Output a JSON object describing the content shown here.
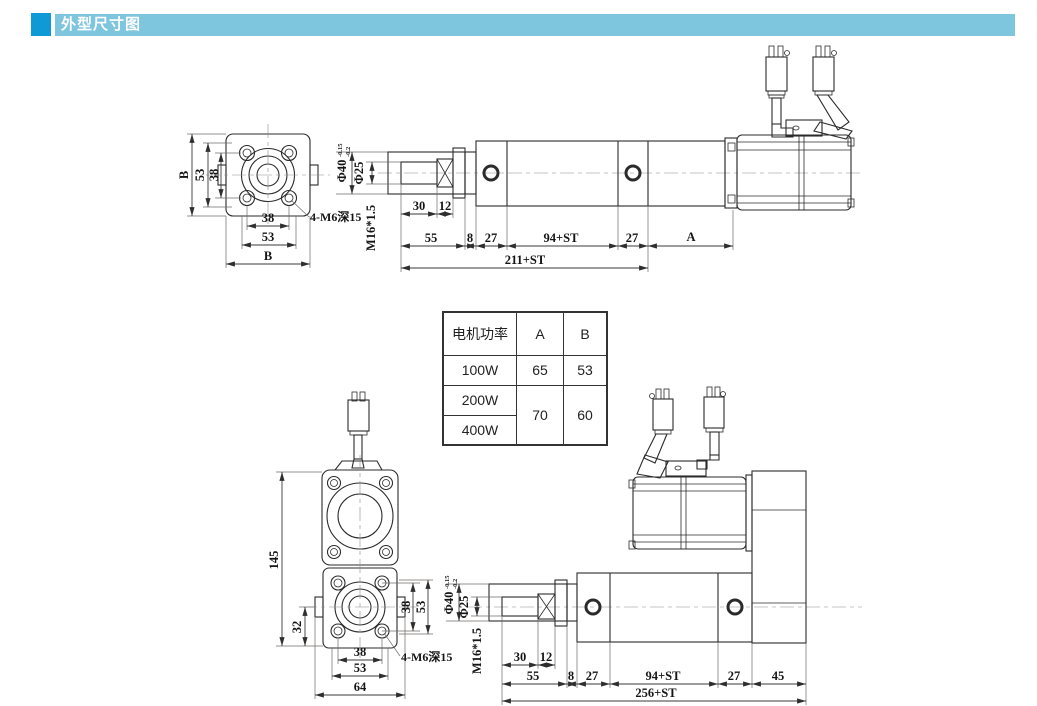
{
  "header": {
    "title": "外型尺寸图"
  },
  "colors": {
    "accent": "#0f9ad6",
    "banner": "#7ec5de",
    "line": "#2b2b2b"
  },
  "table": {
    "col_headers": [
      "电机功率",
      "A",
      "B"
    ],
    "rows": [
      {
        "power": "100W",
        "a": "65",
        "b": "53"
      },
      {
        "power": "200W"
      },
      {
        "power": "400W"
      }
    ],
    "merged": {
      "a": "70",
      "b": "60"
    }
  },
  "top_view": {
    "flange": {
      "dim_b_side": "B",
      "dim_53_side": "53",
      "dim_38_side": "38",
      "dim_38_bottom": "38",
      "dim_53_bottom": "53",
      "dim_b_bottom": "B",
      "thread_note": "4-M6深15"
    },
    "rod": {
      "dia40": "Φ40",
      "dia40_tol_up": "-0.15",
      "dia40_tol_low": "-0.2",
      "dia25": "Φ25",
      "thread": "M16*1.5",
      "dim_30": "30",
      "dim_12": "12"
    },
    "lengths": {
      "dim_55": "55",
      "dim_8": "8",
      "dim_27_front": "27",
      "dim_94st": "94+ST",
      "dim_27_rear": "27",
      "dim_a": "A",
      "dim_total": "211+ST"
    }
  },
  "bottom_view": {
    "front": {
      "dim_145": "145",
      "dim_32": "32",
      "dim_38_side": "38",
      "dim_53_side": "53",
      "dim_38_bottom": "38",
      "dim_53_bottom": "53",
      "dim_64": "64",
      "thread_note": "4-M6深15"
    },
    "rod": {
      "dia40": "Φ40",
      "dia40_tol_up": "-0.15",
      "dia40_tol_low": "-0.2",
      "dia25": "Φ25",
      "thread": "M16*1.5",
      "dim_30": "30",
      "dim_12": "12"
    },
    "lengths": {
      "dim_55": "55",
      "dim_8": "8",
      "dim_27_front": "27",
      "dim_94st": "94+ST",
      "dim_27_rear": "27",
      "dim_45": "45",
      "dim_total": "256+ST"
    }
  }
}
